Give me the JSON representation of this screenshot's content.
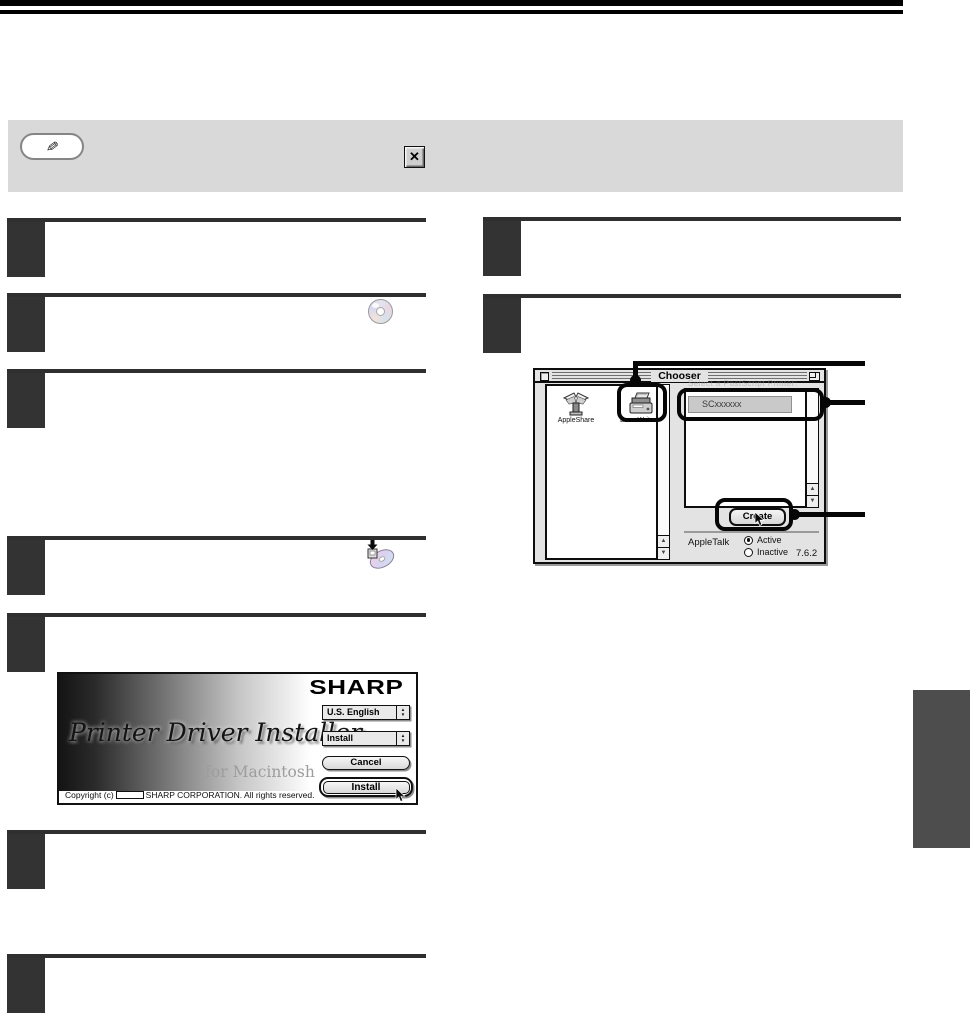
{
  "icons": {
    "note_pencil_glyph": "✎",
    "note_close_glyph": "✕",
    "scroll_up_glyph": "▲",
    "scroll_down_glyph": "▼"
  },
  "chooser": {
    "title": "Chooser",
    "device_icons": [
      {
        "label": "AppleShare"
      },
      {
        "label": "LaserWriter 8"
      }
    ],
    "printer_list_header": "Select a PostScript Printer:",
    "printer_list": [
      {
        "name": "SCxxxxxx"
      }
    ],
    "create_button": "Create",
    "appletalk": {
      "label": "AppleTalk",
      "options": [
        {
          "label": "Active",
          "selected": true
        },
        {
          "label": "Inactive",
          "selected": false
        }
      ]
    },
    "version": "7.6.2"
  },
  "installer": {
    "brand": "SHARP",
    "title": "Printer Driver Installer",
    "subtitle": "for Macintosh",
    "language_dropdown": "U.S. English",
    "action_dropdown": "Install",
    "cancel_button": "Cancel",
    "install_button": "Install",
    "copyright_prefix": "Copyright (c)",
    "copyright_suffix": "SHARP CORPORATION. All rights reserved."
  }
}
